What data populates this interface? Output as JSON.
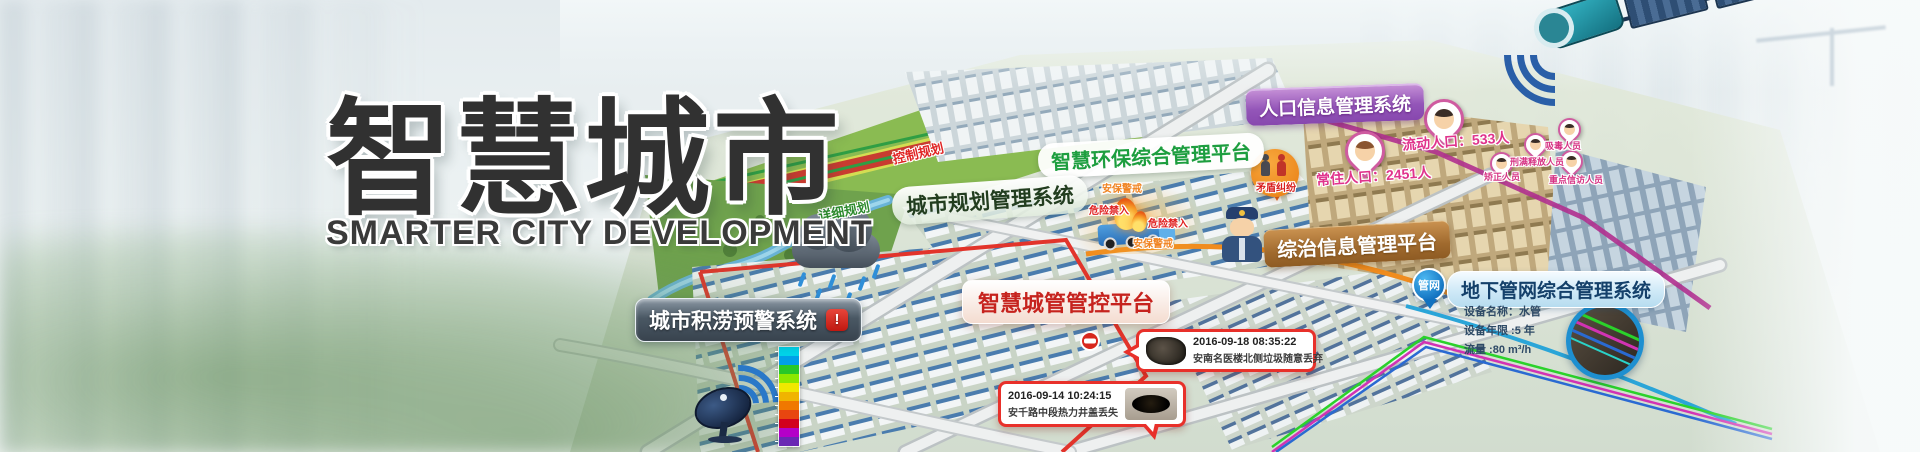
{
  "banner": {
    "title": "智慧城市",
    "subtitle": "SMARTER CITY DEVELOPMENT"
  },
  "labels": {
    "env_platform": "智慧环保综合管理平台",
    "urban_planning": "城市规划管理系统",
    "population_system": "人口信息管理系统",
    "governance_platform": "综治信息管理平台",
    "city_mgmt_platform": "智慧城管管控平台",
    "pipeline_system": "地下管网综合管理系统",
    "flood_warning_system": "城市积涝预警系统",
    "flood_alert_glyph": "!"
  },
  "planning": {
    "control_zone": "控制规划",
    "detail_zone": "详细规划"
  },
  "population": {
    "floating": "流动人口：533人",
    "resident": "常住人口：2451人",
    "dispute": "矛盾纠纷",
    "tags": [
      {
        "label": "吸毒人员"
      },
      {
        "label": "刑满释放人员"
      },
      {
        "label": "矫正人员"
      },
      {
        "label": "重点信访人员"
      }
    ]
  },
  "security": {
    "guard_top": "安保警戒",
    "danger_left": "危险禁入",
    "danger_right": "危险禁入",
    "guard_bottom": "安保警戒"
  },
  "pipeline": {
    "pin": "管网",
    "device_name": "设备名称：水管",
    "device_age": "设备年限 :5 年",
    "flow": "流量 :80 m³/h"
  },
  "incidents": [
    {
      "time": "2016-09-18 08:35:22",
      "desc": "安南名医楼北侧垃圾随意丢弃"
    },
    {
      "time": "2016-09-14 10:24:15",
      "desc": "安千路中段热力井盖丢失"
    }
  ],
  "icons": {
    "pipeline_pin": "network-pin-icon",
    "flood_alert": "alarm-icon",
    "satellite": "satellite-icon",
    "dish": "satellite-dish-icon",
    "rain_cloud": "rain-cloud-icon",
    "policeman": "police-officer-icon",
    "fire": "fire-icon",
    "truck": "truck-icon",
    "warning_triangle": "warning-triangle-icon",
    "no_entry": "no-entry-icon",
    "person_pin": "person-pin-icon",
    "dispute_circle": "dispute-icon"
  },
  "colors": {
    "accent_red": "#e03c31",
    "accent_orange": "#f08c1e",
    "accent_purple": "#9b59b6",
    "accent_green": "#1d9e3f",
    "accent_blue": "#1e8fd0",
    "accent_magenta": "#d5569b",
    "title_text": "#313131"
  },
  "flood_legend_colors": [
    "#00d2e8",
    "#00a0e8",
    "#28c828",
    "#8ce800",
    "#f0e800",
    "#f0b400",
    "#f07800",
    "#e84610",
    "#d2001e",
    "#b400c8",
    "#6a28b4"
  ]
}
